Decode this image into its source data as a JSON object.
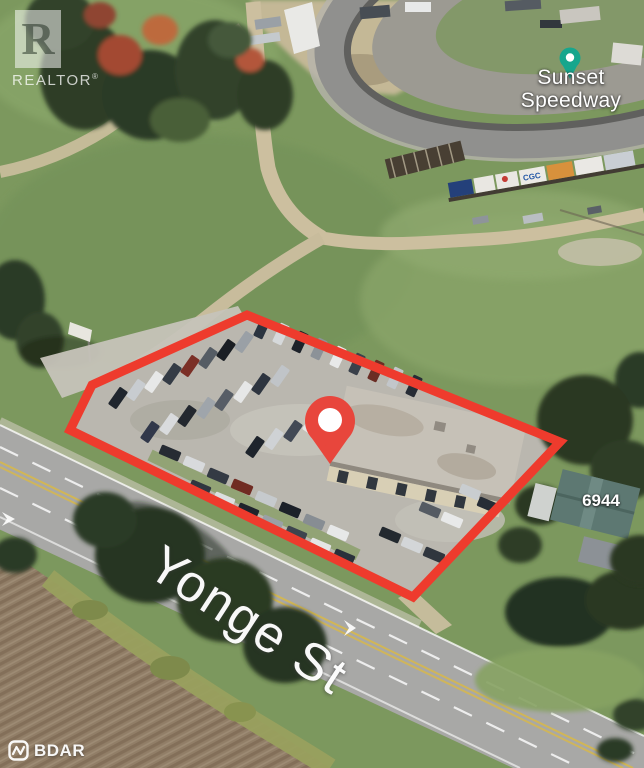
{
  "branding": {
    "realtor_monogram": "R",
    "realtor_wordmark": "REALTOR",
    "realtor_registered": "®",
    "bdar_wordmark": "BDAR"
  },
  "map": {
    "poi": {
      "line1": "Sunset",
      "line2": "Speedway"
    },
    "street": "Yonge St",
    "house_number": "6944"
  },
  "markers": {
    "property_pin": {
      "color": "#e8463c"
    },
    "poi_pin": {
      "color": "#17a68d"
    }
  },
  "annotations": {
    "property_outline_color": "#ee3b2d"
  },
  "scene": {
    "billboard_text": "CGC"
  }
}
